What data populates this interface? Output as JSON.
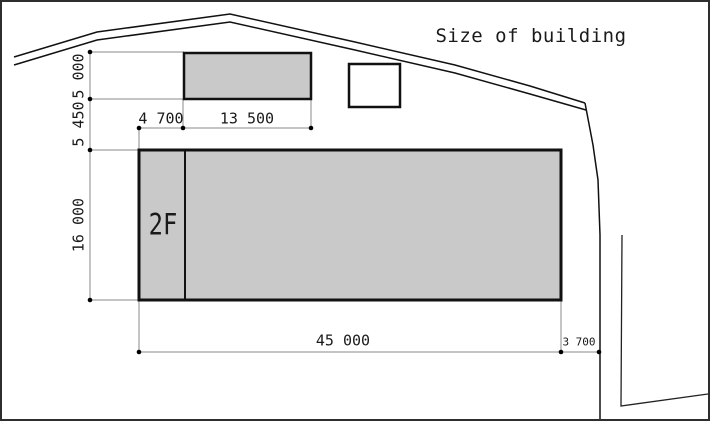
{
  "title": "Size of building",
  "building": {
    "floor_label": "2F"
  },
  "dimensions": {
    "upper_rect_height": "5 000",
    "between_height": "5 450",
    "main_rect_height": "16 000",
    "upper_rect_offset": "4 700",
    "upper_rect_width": "13 500",
    "main_rect_width": "45 000",
    "right_offset": "3 700"
  },
  "colors": {
    "background": "#ffffff",
    "border": "#2e2e2e",
    "building_fill": "#c9c9c9",
    "outline": "#111111",
    "dimension_line": "#8a8a8a",
    "text": "#1a1a1a"
  }
}
